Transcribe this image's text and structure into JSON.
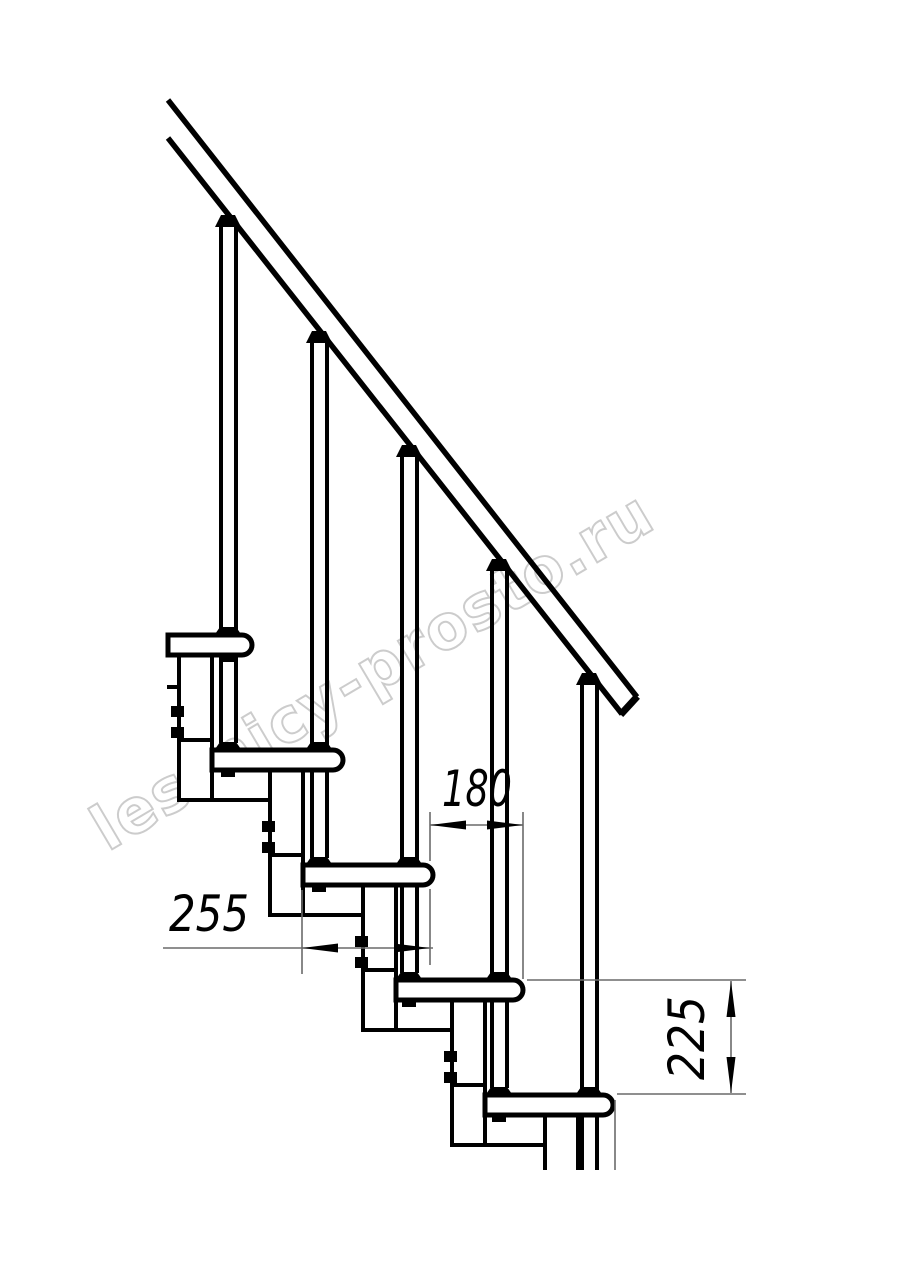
{
  "page": {
    "width": 914,
    "height": 1280,
    "background": "#ffffff"
  },
  "colors": {
    "line": "#000000",
    "thin_line": "#6a6a6a",
    "watermark": "#c4c4c4",
    "background": "#ffffff"
  },
  "watermark": {
    "text": "lestnicy-prosto.ru"
  },
  "drawing": {
    "type": "modular-staircase-side-view",
    "tread_count": 5,
    "baluster_count": 5
  },
  "dimensions": {
    "going": {
      "value": "180"
    },
    "tread_depth": {
      "value": "255"
    },
    "rise": {
      "value": "225"
    }
  }
}
